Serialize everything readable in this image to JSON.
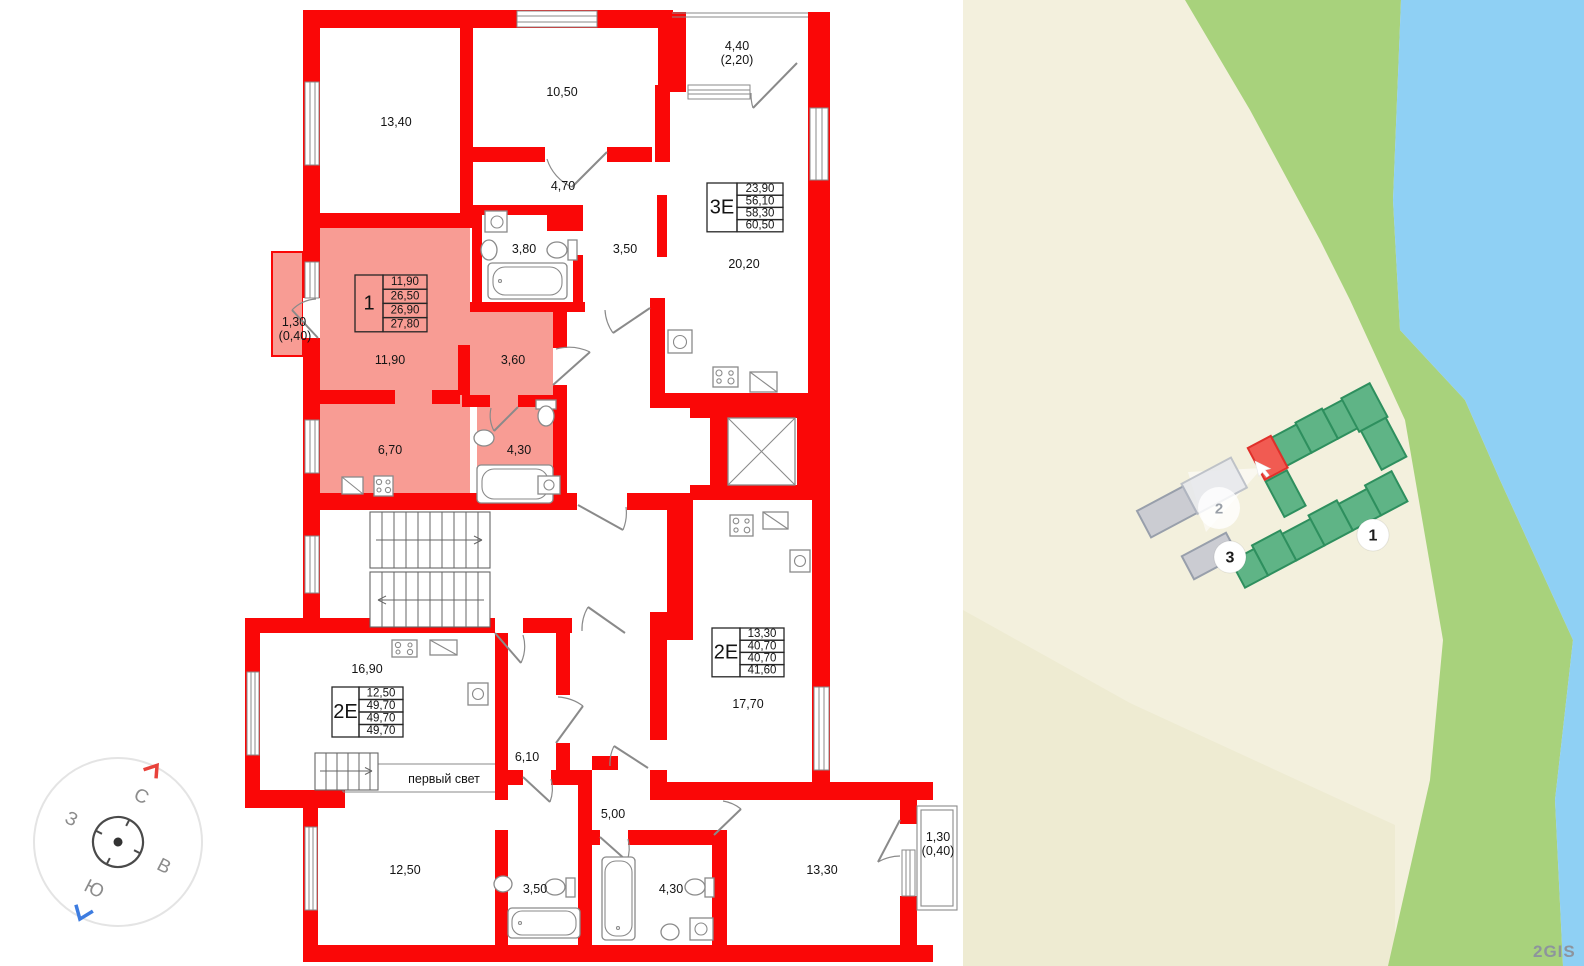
{
  "colors": {
    "wall_red": "#fa0707",
    "apartment_highlight": "#f89c94",
    "land": "#f3f0dd",
    "land_shade": "#eeebd2",
    "greenbelt": "#a8d27c",
    "water": "#8fd0f4",
    "bldg_green": "#5fb486",
    "bldg_green_stroke": "#2e8f5e",
    "bldg_sel": "#f15b52",
    "bldg_sel_stroke": "#e0302a",
    "bldg_gray": "#cbccd2",
    "bldg_gray_stroke": "#989fab",
    "bldg_ghost": "#e7e8ed",
    "bldg_ghost_stroke": "#b5bac4"
  },
  "plan": {
    "room_labels": [
      {
        "t": "13,40",
        "x": 396,
        "y": 122
      },
      {
        "t": "10,50",
        "x": 562,
        "y": 92
      },
      {
        "t": "4,40",
        "x": 737,
        "y": 46
      },
      {
        "t": "(2,20)",
        "x": 737,
        "y": 60
      },
      {
        "t": "4,70",
        "x": 563,
        "y": 186
      },
      {
        "t": "3,80",
        "x": 524,
        "y": 249
      },
      {
        "t": "3,50",
        "x": 625,
        "y": 249
      },
      {
        "t": "20,20",
        "x": 744,
        "y": 264
      },
      {
        "t": "1,30",
        "x": 294,
        "y": 322
      },
      {
        "t": "(0,40)",
        "x": 295,
        "y": 336
      },
      {
        "t": "11,90",
        "x": 390,
        "y": 360
      },
      {
        "t": "3,60",
        "x": 513,
        "y": 360
      },
      {
        "t": "6,70",
        "x": 390,
        "y": 450
      },
      {
        "t": "4,30",
        "x": 519,
        "y": 450
      },
      {
        "t": "16,90",
        "x": 367,
        "y": 669
      },
      {
        "t": "6,10",
        "x": 527,
        "y": 757
      },
      {
        "t": "5,00",
        "x": 613,
        "y": 814
      },
      {
        "t": "12,50",
        "x": 405,
        "y": 870
      },
      {
        "t": "3,50",
        "x": 535,
        "y": 889
      },
      {
        "t": "4,30",
        "x": 671,
        "y": 889
      },
      {
        "t": "13,30",
        "x": 822,
        "y": 870
      },
      {
        "t": "1,30",
        "x": 938,
        "y": 837
      },
      {
        "t": "(0,40)",
        "x": 938,
        "y": 851
      },
      {
        "t": "17,70",
        "x": 748,
        "y": 704
      }
    ],
    "void_label": {
      "t": "первый свет",
      "x": 444,
      "y": 779
    },
    "apartment_tables": [
      {
        "type": "1",
        "values": [
          "11,90",
          "26,50",
          "26,90",
          "27,80"
        ],
        "x": 355,
        "y": 275,
        "row_h": 14.2,
        "head_w": 28,
        "val_w": 44
      },
      {
        "type": "3Е",
        "values": [
          "23,90",
          "56,10",
          "58,30",
          "60,50"
        ],
        "x": 707,
        "y": 183,
        "row_h": 12.2,
        "head_w": 30,
        "val_w": 46
      },
      {
        "type": "2Е",
        "values": [
          "13,30",
          "40,70",
          "40,70",
          "41,60"
        ],
        "x": 712,
        "y": 628,
        "row_h": 12.2,
        "head_w": 28,
        "val_w": 44
      },
      {
        "type": "2Е",
        "values": [
          "12,50",
          "49,70",
          "49,70",
          "49,70"
        ],
        "x": 332,
        "y": 687,
        "row_h": 12.5,
        "head_w": 27,
        "val_w": 44
      }
    ],
    "compass": {
      "north": "С",
      "south": "Ю",
      "west": "З",
      "east": "В"
    }
  },
  "map": {
    "markers": [
      {
        "label": "1",
        "x": 1373,
        "y": 535
      },
      {
        "label": "2",
        "x": 1219,
        "y": 508
      },
      {
        "label": "3",
        "x": 1230,
        "y": 557
      }
    ],
    "watermark": "2GIS"
  }
}
